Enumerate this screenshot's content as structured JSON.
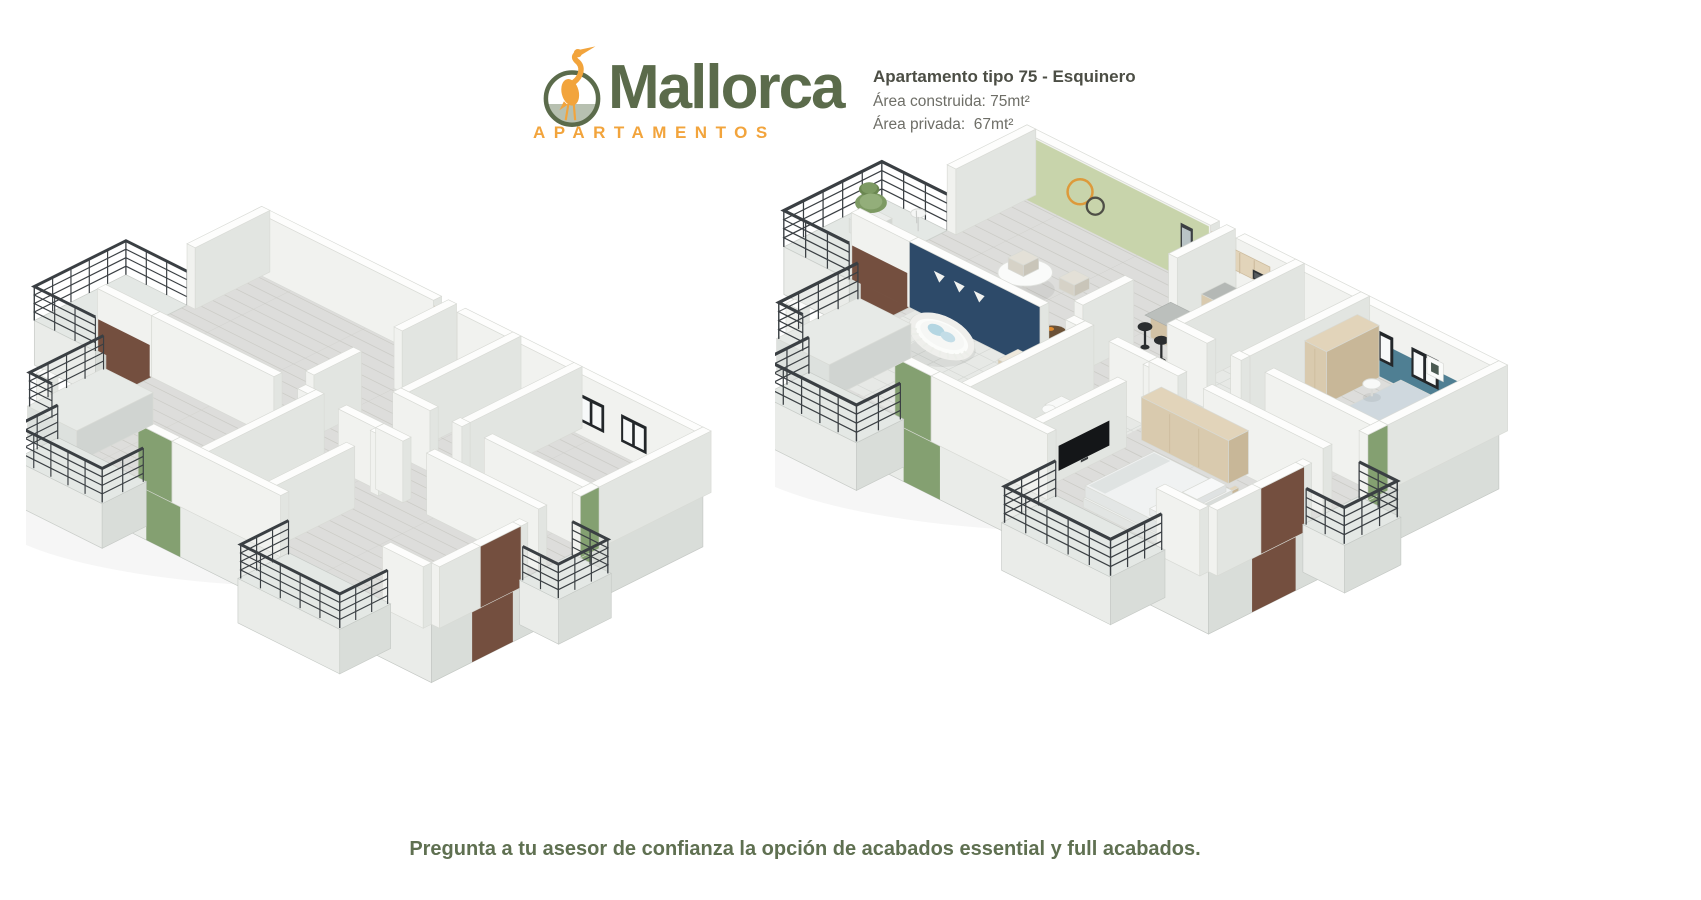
{
  "logo": {
    "brand": "Mallorca",
    "tagline": "APARTAMENTOS",
    "icon": "heron-in-circle-icon"
  },
  "unit_info": {
    "title": "Apartamento tipo 75 - Esquinero",
    "built_area": "Área construida: 75mt²",
    "private_area": "Área privada:  67mt²"
  },
  "footer": {
    "note": "Pregunta a tu asesor de confianza la opción de acabados essential y full acabados."
  },
  "floor_plans": {
    "left": {
      "variant": "unfurnished"
    },
    "right": {
      "variant": "furnished"
    }
  },
  "colors": {
    "brand_green": "#5b6b4b",
    "brand_orange": "#f2a43c",
    "logo_ground": "#b7c0b0",
    "title_text": "#4c4e45",
    "body_text": "#6e6e67",
    "footer_text": "#5f7051",
    "wall_top": "#fdfdfc",
    "wall_south": "#f1f2ef",
    "wall_east": "#e2e5e1",
    "wall_stroke": "#d8dad5",
    "slab_south": "#eaece9",
    "slab_east": "#d9ddd9",
    "floor_wood": "#dddddb",
    "floor_plank_line": "#cbcbc6",
    "floor_tile": "#e7e9e6",
    "floor_tile_line": "#d5d8d4",
    "balcony_floor": "#e4e8e5",
    "railing": "#3a3f43",
    "accent_sage_wall": "#c8d4ab",
    "accent_navy_wall": "#2d4a69",
    "accent_teal_wall": "#4f7f93",
    "accent_olive_panel": "#84a071",
    "brick": "#744f3f",
    "wood_furniture": "#d9caae",
    "wood_furniture_dark": "#c8b798",
    "wood_furniture_top": "#e2d4ba",
    "granite": "#b4b8b5",
    "appliance_gray": "#a9aeb1",
    "black_furniture": "#2a2d2f",
    "window_frame": "#23272a",
    "door_tan": "#ccb08f",
    "duvet_blue": "#cfd8de",
    "pillow_blue": "#b4d6e2"
  }
}
